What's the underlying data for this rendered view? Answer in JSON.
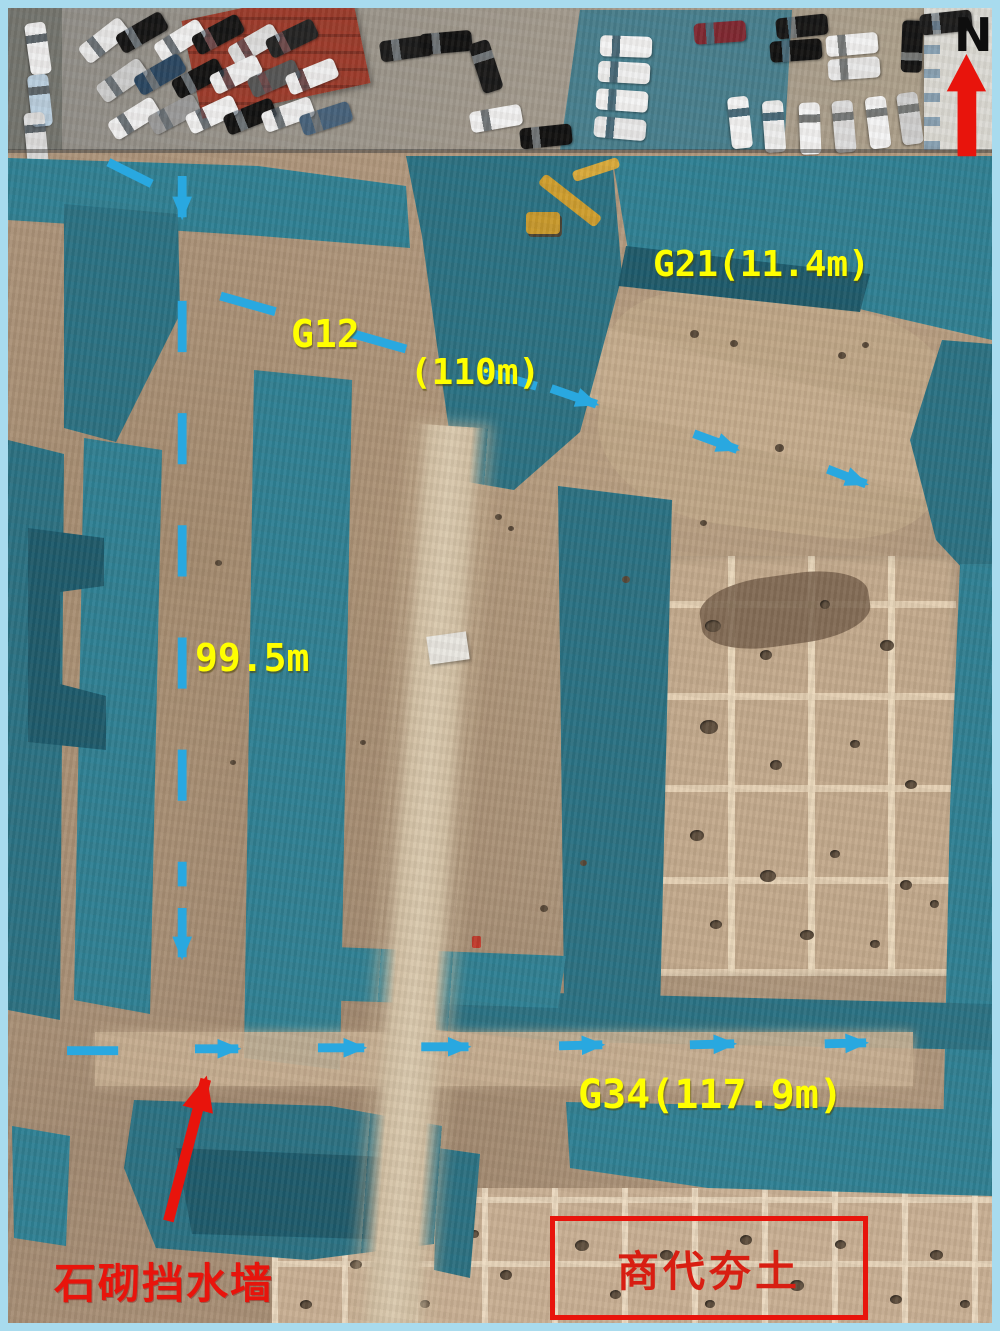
{
  "figure": {
    "type": "annotated aerial drone photograph",
    "subject": "archaeological excavation site covered with protective tarps, parking lots and buildings along the top edge",
    "north_indicator": "N",
    "labels": {
      "g21": "G21(11.4m)",
      "g12": "G12",
      "g12_length": "(110m)",
      "west_trench_length": "99.5m",
      "g34": "G34(117.9m)",
      "retaining_wall": "石砌挡水墙",
      "shang_rammed_earth": "商代夯土"
    },
    "colors": {
      "label_yellow": "#ffff00",
      "line_blue": "#29a8e0",
      "annotation_red": "#e8140c",
      "tarp_teal": "#2e7d8e",
      "earth_tan": "#b49a7f",
      "frame_blue": "#a8dbee"
    }
  }
}
